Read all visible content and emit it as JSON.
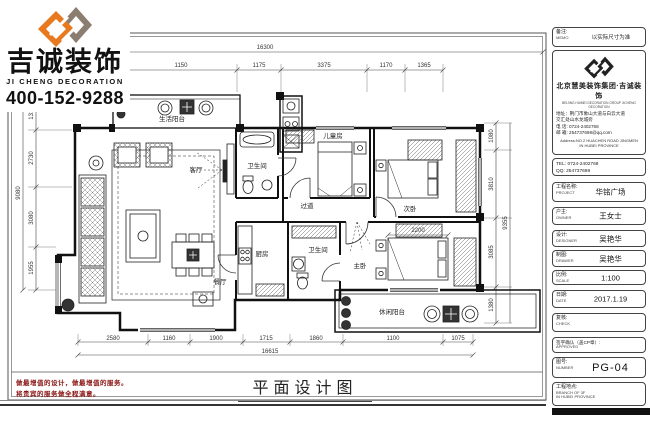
{
  "brand": {
    "name": "吉诚装饰",
    "name_en": "JI CHENG DECORATION",
    "phone": "400-152-9288",
    "orange": "#E8791F",
    "taupe": "#8B7D70"
  },
  "sheet": {
    "drawing_title": "平面设计图",
    "slogan_line1": "做最增值的设计，做最增值的服务。",
    "slogan_line2": "将贵宾的服务做全程满意。"
  },
  "titleblock": {
    "memo_label": "备注:",
    "memo_label_en": "MEMO",
    "memo_value": "以实际尺寸为准",
    "company": "北京慧美装饰集团·吉诚装饰",
    "company_en": "BEIJING HUIMEI DECORATION GROUP JICHENG DECORATION",
    "address_line1": "地址：荆门市象山大道与白云大道",
    "address_line2": "交汇处山水龙城旁",
    "tel_line": "电 话: 0724-2402768",
    "email_line": "邮 箱: 254737698@qq.com",
    "address_en1": "Address:NO.2 HUACHEN ROAD JINGMEN",
    "address_en2": "IN HUBEI PROVINCE",
    "tel2_line1": "TEL: 0724-2402768",
    "tel2_line2": "QQ: 254737698",
    "rows": [
      {
        "label": "工程名称:",
        "label_en": "PROJECT",
        "value": "华铭广场"
      },
      {
        "label": "户主:",
        "label_en": "OWNER",
        "value": "王女士"
      },
      {
        "label": "设计:",
        "label_en": "DESIGNER",
        "value": "吴艳华"
      },
      {
        "label": "制图:",
        "label_en": "DRAWER",
        "value": "吴艳华"
      },
      {
        "label": "比例:",
        "label_en": "SCALE",
        "value": "1:100"
      },
      {
        "label": "日期:",
        "label_en": "DATE",
        "value": "2017.1.19"
      },
      {
        "label": "复核:",
        "label_en": "CHECK",
        "value": ""
      },
      {
        "label": "签字确认（盖CP章）:",
        "label_en": "APPROVED",
        "value": ""
      },
      {
        "label": "图号:",
        "label_en": "NUMBER",
        "value": "PG-04"
      }
    ],
    "site_label": "工程地点:",
    "site_line1": "BRANCH OF 3F",
    "site_line2": "IN HUBEI PROVINCE"
  },
  "plan": {
    "rooms": {
      "living": "客厅",
      "dining": "餐厅",
      "kitchen": "厨房",
      "bath1": "卫生间",
      "bath2": "卫生间",
      "hall": "过道",
      "bedroom_kids": "儿童房",
      "bedroom_second": "次卧",
      "bedroom_master": "主卧",
      "balcony_service": "生活阳台",
      "balcony_leisure": "休闲阳台"
    },
    "dims": {
      "top_overall": "16300",
      "top": [
        "1150",
        "1175",
        "3375",
        "1170",
        "1365"
      ],
      "bottom": [
        "2580",
        "1160",
        "1900",
        "1715",
        "1860",
        "1100",
        "1075"
      ],
      "bottom_overall": "16615",
      "left": [
        "1315",
        "2730",
        "3080",
        "1955"
      ],
      "left_overall": "9080",
      "right": [
        "1080",
        "3810",
        "3085",
        "1380"
      ],
      "right_overall": "9355",
      "bed_master": "2200"
    }
  }
}
